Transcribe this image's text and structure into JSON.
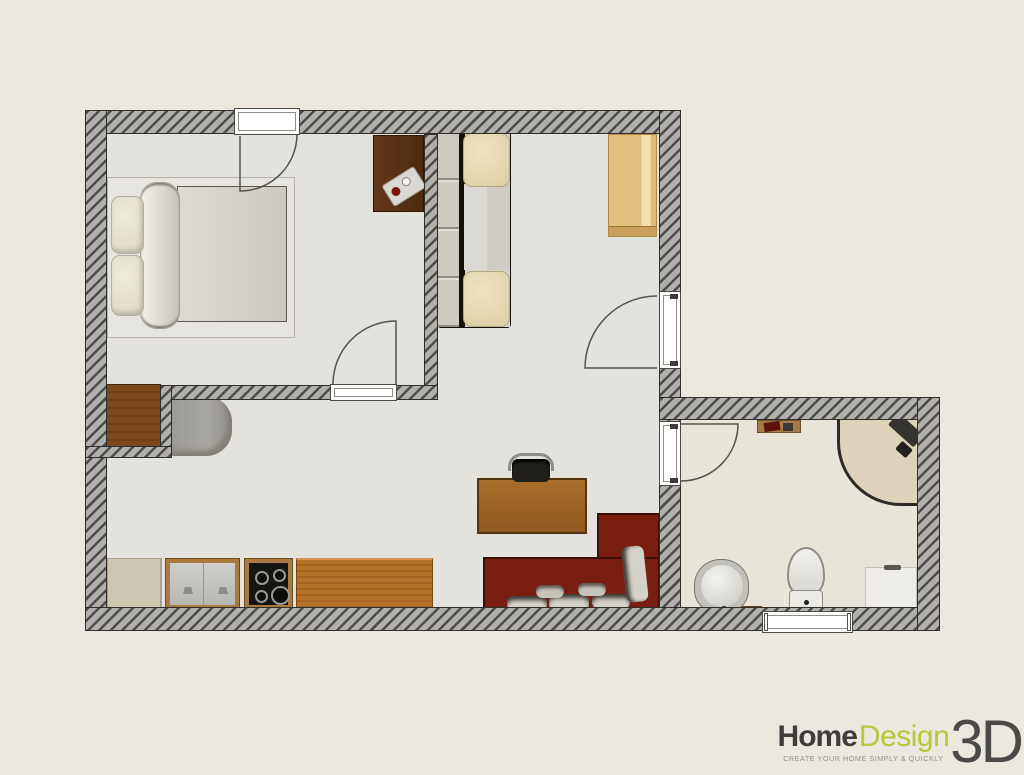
{
  "app": {
    "name": "Home Design 3D"
  },
  "logo": {
    "word_home": "Home",
    "word_design": "Design",
    "word_3d": "3D",
    "tagline": "CREATE YOUR HOME SIMPLY & QUICKLY"
  },
  "palette": {
    "bg": "#ece7df",
    "wall-fill": "#b1b0ac",
    "wall-stripe": "#4e4d49",
    "wall-border": "#2f2e2b",
    "floor": "#e4e2dd",
    "floor-bath": "#e9e4d9",
    "arc": "#55534e",
    "logo-green": "#b6c93a",
    "logo-dark": "#3d3d3c",
    "logo-3d": "#4a4a49",
    "tagline": "#91908b",
    "sofa-red": "#7a1d11",
    "wood-dark": "#5e3417",
    "wood-dresser": "#7d4a1d",
    "wood-counter": "#ad6e26",
    "wood-light": "#e6c485",
    "cream": "#e7dcba",
    "white-fixture": "#edece8"
  },
  "rooms": [
    {
      "name": "bedroom"
    },
    {
      "name": "living-room-kitchen"
    },
    {
      "name": "bathroom"
    }
  ],
  "furniture": [
    "double-bed",
    "rug",
    "bedroom-desk",
    "media-tray",
    "dresser",
    "armchair",
    "white-sofa",
    "wardrobe",
    "office-desk",
    "office-chair",
    "red-corner-sofa",
    "kitchen-cabinet",
    "kitchen-sink",
    "cooktop",
    "kitchen-counter",
    "wall-shelf",
    "corner-shower",
    "bidet",
    "toilet",
    "washing-machine",
    "bath-mat"
  ],
  "openings": {
    "doors": [
      "bedroom-north-door",
      "bedroom-south-door",
      "entry-door",
      "bathroom-door"
    ],
    "windows": [
      "bathroom-window"
    ]
  }
}
